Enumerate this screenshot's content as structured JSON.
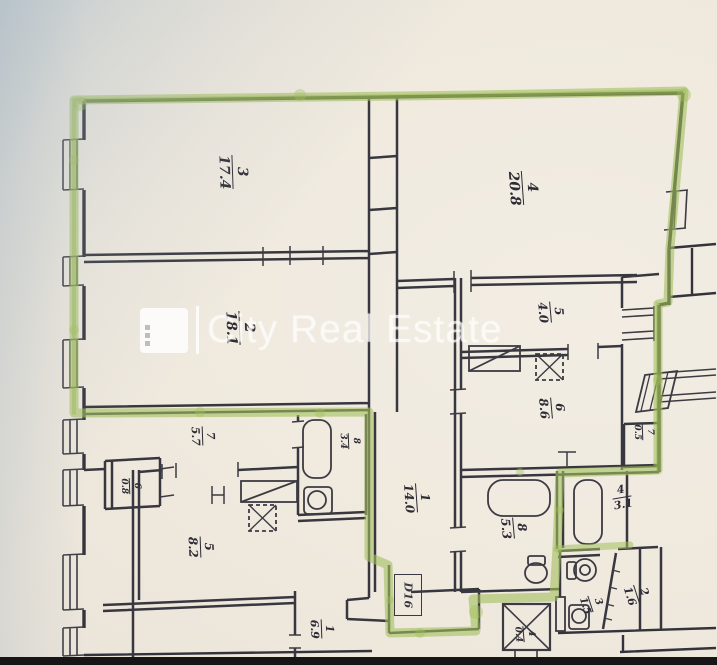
{
  "watermark": {
    "brand": "City Real Estate"
  },
  "door": {
    "label": "D16"
  },
  "colors": {
    "highlight_green": "#a2bf5c",
    "ink": "#34333c",
    "paper": "#eee8de"
  },
  "rooms": [
    {
      "num": "3",
      "area": "17.4",
      "x": 233,
      "y": 172,
      "rot": 88,
      "size": 14
    },
    {
      "num": "4",
      "area": "20.8",
      "x": 523,
      "y": 188,
      "rot": 86,
      "size": 14
    },
    {
      "num": "2",
      "area": "18.1",
      "x": 240,
      "y": 328,
      "rot": 88,
      "size": 14
    },
    {
      "num": "5",
      "area": "4.0",
      "x": 551,
      "y": 312,
      "rot": 85,
      "size": 12
    },
    {
      "num": "6",
      "area": "8.6",
      "x": 552,
      "y": 408,
      "rot": 85,
      "size": 12
    },
    {
      "num": "7",
      "area": "0.5",
      "x": 643,
      "y": 432,
      "rot": 88,
      "size": 9
    },
    {
      "num": "1",
      "area": "14.0",
      "x": 417,
      "y": 498,
      "rot": 86,
      "size": 12
    },
    {
      "num": "8",
      "area": "5.3",
      "x": 514,
      "y": 528,
      "rot": 85,
      "size": 12
    },
    {
      "num": "4",
      "area": "3.1",
      "x": 622,
      "y": 497,
      "rot": -10,
      "size": 11
    },
    {
      "num": "2",
      "area": "1.6",
      "x": 637,
      "y": 594,
      "rot": 72,
      "size": 11
    },
    {
      "num": "3",
      "area": "1.5",
      "x": 591,
      "y": 604,
      "rot": 72,
      "size": 10
    },
    {
      "num": "8",
      "area": "3.4",
      "x": 349,
      "y": 441,
      "rot": 88,
      "size": 9
    },
    {
      "num": "7",
      "area": "5.7",
      "x": 203,
      "y": 436,
      "rot": 88,
      "size": 11
    },
    {
      "num": "6",
      "area": "0.8",
      "x": 130,
      "y": 486,
      "rot": 88,
      "size": 9
    },
    {
      "num": "5",
      "area": "8.2",
      "x": 201,
      "y": 547,
      "rot": 88,
      "size": 12
    },
    {
      "num": "1",
      "area": "6.9",
      "x": 322,
      "y": 629,
      "rot": 88,
      "size": 11
    },
    {
      "num": "4",
      "area": "0.4",
      "x": 524,
      "y": 634,
      "rot": 85,
      "size": 9
    }
  ],
  "dimensions": [
    {
      "text": "5.53",
      "x": 233,
      "y": 121,
      "rot": -6
    },
    {
      "text": "5.88",
      "x": 541,
      "y": 127,
      "rot": -6
    },
    {
      "text": "3.15",
      "x": 117,
      "y": 227,
      "rot": 82
    },
    {
      "text": "5.53",
      "x": 233,
      "y": 272,
      "rot": -6
    },
    {
      "text": "3.28",
      "x": 118,
      "y": 394,
      "rot": 84
    },
    {
      "text": "3.53",
      "x": 657,
      "y": 236,
      "rot": -78
    },
    {
      "text": "1.17",
      "x": 621,
      "y": 313,
      "rot": 78
    },
    {
      "text": "2.70",
      "x": 620,
      "y": 411,
      "rot": 80
    },
    {
      "text": "5.15",
      "x": 666,
      "y": 590,
      "rot": 80
    },
    {
      "text": "1.34",
      "x": 427,
      "y": 291,
      "rot": -10
    },
    {
      "text": "3.39",
      "x": 546,
      "y": 286,
      "rot": -6
    },
    {
      "text": "1.14",
      "x": 492,
      "y": 375,
      "rot": -8
    },
    {
      "text": "0.42",
      "x": 529,
      "y": 367,
      "rot": 78
    },
    {
      "text": "3.38",
      "x": 487,
      "y": 398,
      "rot": -14
    },
    {
      "text": "1.07",
      "x": 386,
      "y": 445,
      "rot": 84
    },
    {
      "text": "0.87",
      "x": 407,
      "y": 460,
      "rot": -8
    },
    {
      "text": "2.52",
      "x": 359,
      "y": 501,
      "rot": 80
    },
    {
      "text": "2.10",
      "x": 471,
      "y": 570,
      "rot": 80
    },
    {
      "text": "0.96",
      "x": 473,
      "y": 608,
      "rot": 74
    },
    {
      "text": "0.43",
      "x": 452,
      "y": 597,
      "rot": -8
    },
    {
      "text": "0.25",
      "x": 356,
      "y": 599,
      "rot": -14
    },
    {
      "text": "2.03",
      "x": 374,
      "y": 587,
      "rot": 84
    },
    {
      "text": "4.03",
      "x": 276,
      "y": 423,
      "rot": -8
    },
    {
      "text": "1.51",
      "x": 285,
      "y": 447,
      "rot": 72
    },
    {
      "text": "1.48",
      "x": 344,
      "y": 420,
      "rot": -14
    },
    {
      "text": "1.18",
      "x": 130,
      "y": 451,
      "rot": -8
    },
    {
      "text": "0.45",
      "x": 167,
      "y": 462,
      "rot": 80
    },
    {
      "text": "0.40",
      "x": 166,
      "y": 503,
      "rot": 80
    },
    {
      "text": "1.18",
      "x": 127,
      "y": 517,
      "rot": -8
    },
    {
      "text": "0.42",
      "x": 227,
      "y": 499,
      "rot": 80
    },
    {
      "text": "2.27",
      "x": 196,
      "y": 508,
      "rot": 80
    },
    {
      "text": "1.20",
      "x": 282,
      "y": 507,
      "rot": -10
    },
    {
      "text": "4.03",
      "x": 213,
      "y": 586,
      "rot": -8
    },
    {
      "text": "2.58",
      "x": 478,
      "y": 517,
      "rot": 74
    },
    {
      "text": "2.02",
      "x": 613,
      "y": 482,
      "rot": -8
    },
    {
      "text": "1.52",
      "x": 612,
      "y": 528,
      "rot": 72
    },
    {
      "text": "0.70",
      "x": 637,
      "y": 558,
      "rot": -8
    },
    {
      "text": "1.21",
      "x": 604,
      "y": 557,
      "rot": -16
    },
    {
      "text": "0.87",
      "x": 580,
      "y": 608,
      "rot": 74
    },
    {
      "text": "1.07",
      "x": 626,
      "y": 621,
      "rot": -4
    }
  ]
}
